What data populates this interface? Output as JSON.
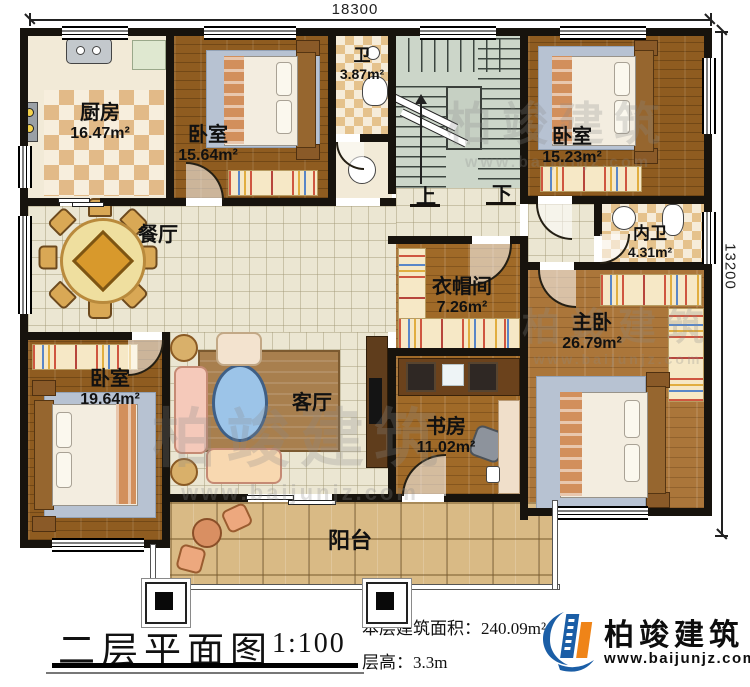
{
  "dimensions": {
    "top": "18300",
    "right": "13200"
  },
  "rooms": {
    "kitchen": {
      "name": "厨房",
      "area": "16.47m²"
    },
    "bedroom_top": {
      "name": "卧室",
      "area": "15.64m²"
    },
    "bath": {
      "name": "卫",
      "area": "3.87m²"
    },
    "bedroom_right": {
      "name": "卧室",
      "area": "15.23m²"
    },
    "dining": {
      "name": "餐厅"
    },
    "inner_bath": {
      "name": "内卫",
      "area": "4.31m²"
    },
    "cloakroom": {
      "name": "衣帽间",
      "area": "7.26m²"
    },
    "master": {
      "name": "主卧",
      "area": "26.79m²"
    },
    "bedroom_left": {
      "name": "卧室",
      "area": "19.64m²"
    },
    "living": {
      "name": "客厅"
    },
    "study": {
      "name": "书房",
      "area": "11.02m²"
    },
    "balcony": {
      "name": "阳台"
    }
  },
  "stairs": {
    "up": "上",
    "down": "下"
  },
  "title_block": {
    "title": "二层平面图",
    "scale": "1:100",
    "area_line": "本层建筑面积：240.09m²",
    "height_line": "层高：3.3m"
  },
  "brand": {
    "name": "柏竣建筑",
    "url": "www.baijunjz.com"
  },
  "colors": {
    "wall": "#17130d",
    "brand_blue": "#1b5ea6",
    "brand_orange": "#ef8418",
    "wood": "#9a6526",
    "tile": "#ebe6d2"
  }
}
